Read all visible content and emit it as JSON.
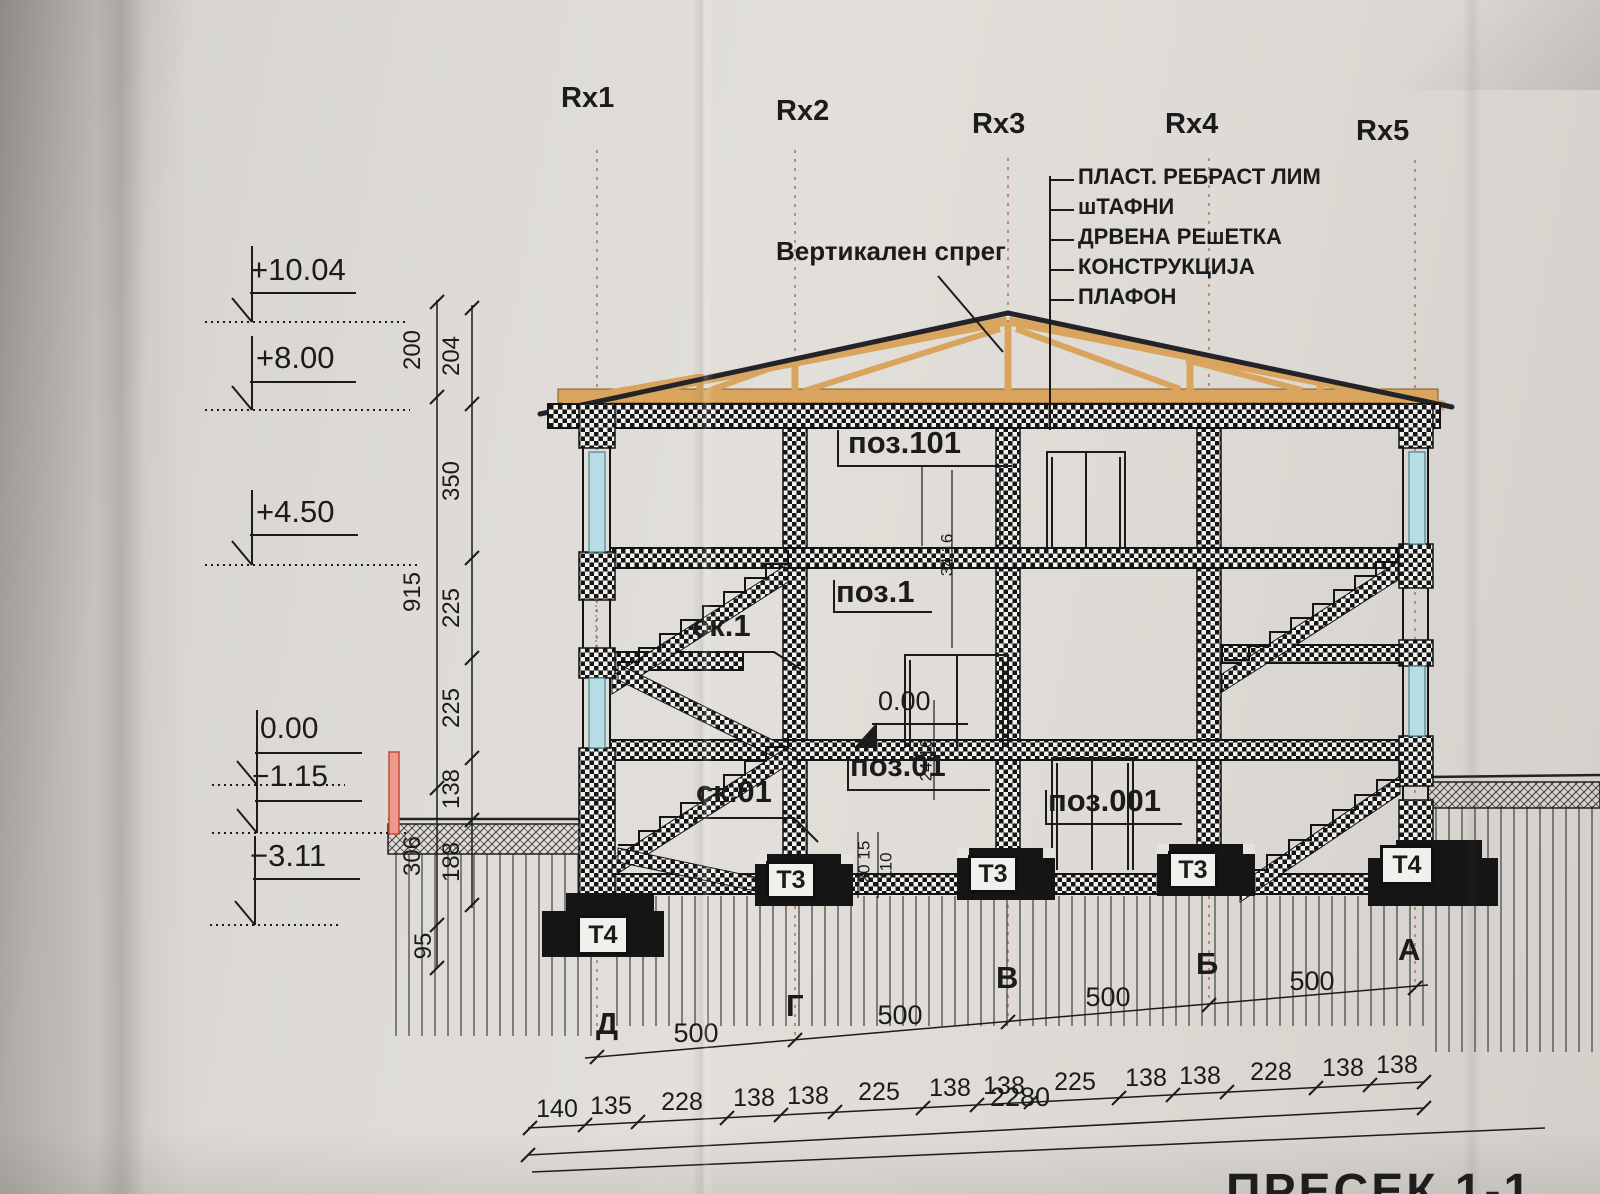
{
  "drawing": {
    "sheet_title_partial": "ПРЕСЕК 1-1",
    "grid": {
      "top_axes": [
        "Rx1",
        "Rx2",
        "Rx3",
        "Rx4",
        "Rx5"
      ],
      "bottom_axes": [
        "Д",
        "Г",
        "В",
        "Б",
        "А"
      ],
      "axis_spacing_dims": [
        "500",
        "500",
        "500",
        "500"
      ]
    },
    "roof_legend": [
      "ПЛАСТ. РЕБРАСТ ЛИМ",
      "шТАФНИ",
      "ДРВЕНА РЕшЕТКА",
      "КОНСТРУКЦИЈА",
      "ПЛАФОН"
    ],
    "callouts": {
      "vertical_brace": "Вертикален спрег",
      "pos": [
        "поз.101",
        "поз.1",
        "поз.01",
        "поз.001"
      ],
      "stairs": [
        "ск.1",
        "ск.01"
      ],
      "floor_zero_inline": "0.00"
    },
    "elevation_marks": [
      "+10.04",
      "+8.00",
      "+4.50",
      "0.00",
      "−1.15",
      "−3.11"
    ],
    "footing_labels": [
      "Т4",
      "Т3",
      "Т3",
      "Т3",
      "Т4"
    ],
    "dims": {
      "bottom_chain": [
        "140",
        "135",
        "228",
        "138",
        "138",
        "225",
        "138",
        "138",
        "225",
        "138",
        "138",
        "228",
        "138",
        "138"
      ],
      "total": "2280",
      "vertical_outer": [
        "200",
        "915",
        "306",
        "95"
      ],
      "vertical_inner": [
        "204",
        "350",
        "225",
        "225",
        "138",
        "188"
      ],
      "small_inline": [
        "34 16",
        "24 16",
        "20 15",
        "110"
      ]
    },
    "colors": {
      "paper": "#dedbd6",
      "ink": "#1b1b1b",
      "grid_red": "#b4614e",
      "truss_wood": "#d9a55e",
      "window_glass": "#b7dde4",
      "marker_red": "#eb9b8d"
    }
  }
}
